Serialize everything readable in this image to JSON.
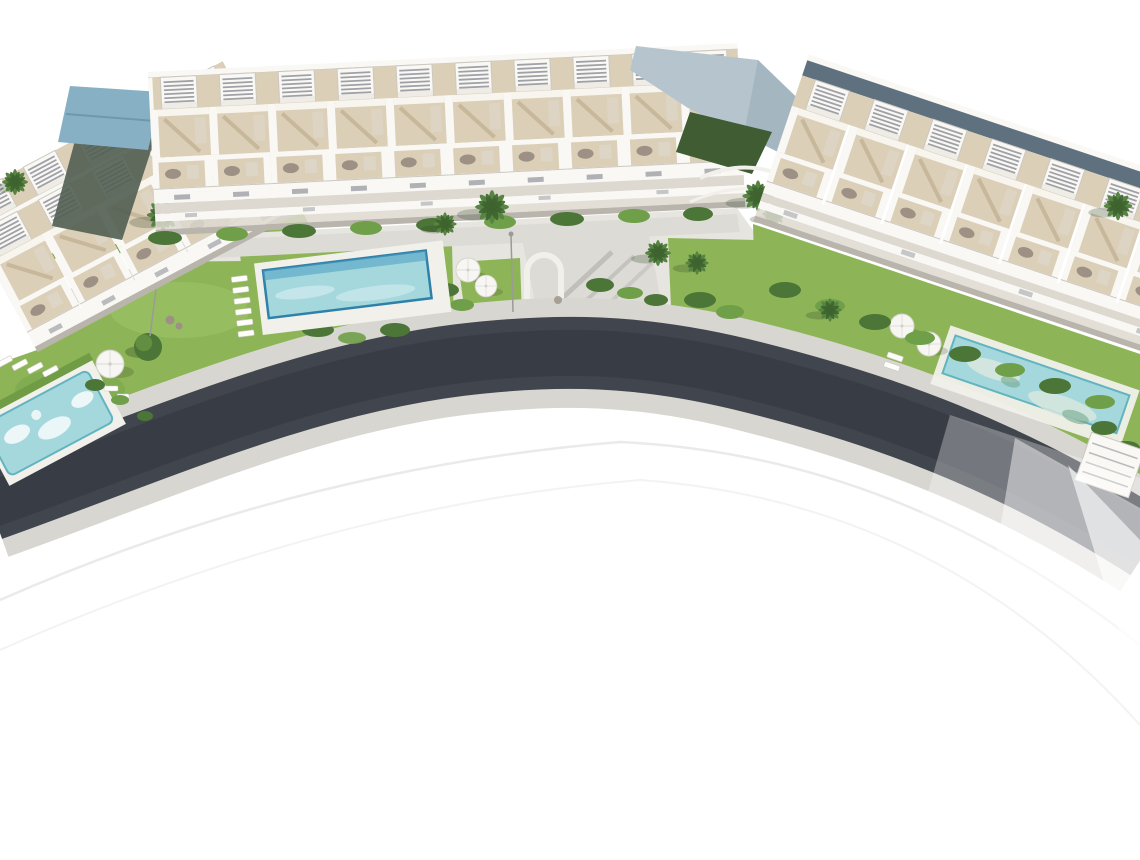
{
  "scene": {
    "type": "architectural-aerial-render",
    "description": "Aerial 3D render of a white residential development: three terraced apartment blocks with slatted rooftop pergolas arranged along a sweeping curved asphalt road, communal gardens with palm trees and hedges, a central rectangular pool with sun loungers, a free-form pool at lower left, an elongated pool with parasols on the right, all on a white background",
    "elements": {
      "left_building": "angled terraced apartment block, upper left",
      "center_building": "long row of townhouses with rooftop pergolas and balconies",
      "right_building": "terraced townhouses stepping down along the road, upper right",
      "blue_roof": "blue-grey sloped roof between left and center blocks",
      "canopy": "pale blue-grey canopy roof between center and right blocks",
      "central_pool": "rectangular turquoise community pool with lounger row",
      "left_pool": "free-form turquoise pool with white island shapes, lower left",
      "right_pool": "elongated diagonal pool with two white parasols",
      "road": "dark curved asphalt road with light sidewalks, fading out lower right",
      "gardens": "green lawns, hedge rows, round bush, white parasols, garden furniture",
      "driveway": "entrance drive with white arch connecting road to promenade",
      "lamp_posts": "two thin street lamps on the promenade"
    }
  },
  "palette": {
    "white": "#ffffff",
    "asphalt": "#41454d",
    "asphalt_core": "#383d45",
    "sidewalk": "#d7d6d1",
    "path": "#e7e5e0",
    "walkway": "#dddbd5",
    "faint_arc": "#e8e8e5",
    "grass": "#8db557",
    "grass_light": "#a3c76f",
    "grass_dark": "#6f9c44",
    "hedge": "#4c7637",
    "hedge_light": "#6f9f48",
    "palm": "#558540",
    "palm_dark": "#3e632f",
    "building_white": "#f9f8f4",
    "building_shade": "#ded9d0",
    "terrace_beige": "#dbcfb7",
    "terrace_shadow": "#c3b295",
    "slat_dark": "#90939a",
    "railing": "#ccc8c0",
    "furniture": "#9c9184",
    "glazing": "#5f707e",
    "canopy_roof": "#b6c5cd",
    "blue_roof": "#88b0c5",
    "dark_wall": "#515e52",
    "dark_lawn": "#3f5c33",
    "pool_water": "#a5d8dd",
    "pool_deep": "#4d9ec2",
    "pool_border": "#2f81a8",
    "pool_rim": "#62b4c0",
    "pool_pale": "#d9e9df",
    "pool_algae": "#74a88d",
    "deck_white": "#f1f0eb",
    "lounger": "#fdfdfa",
    "umbrella": "#f7f6f2",
    "lamp": "#9b9b96",
    "ground_shadow": "#b9b5ad"
  }
}
